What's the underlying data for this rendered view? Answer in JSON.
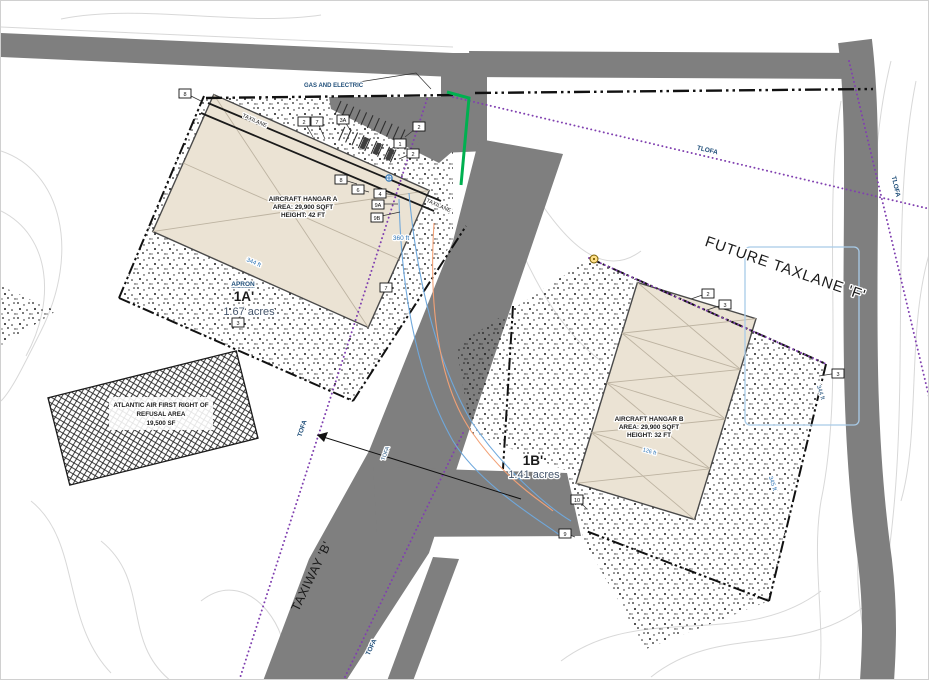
{
  "drawing": {
    "utilities_label": "GAS AND ELECTRIC",
    "future_taxlane_label": "FUTURE TAXLANE 'F'",
    "taxiway_label": "TAXIWAY 'B'"
  },
  "parcel_1a": {
    "apron_label": "APRON",
    "id": "1A'",
    "area": "1.67 acres",
    "hangar": {
      "line1": "AIRCRAFT HANGAR A",
      "line2": "AREA: 29,900 SQFT",
      "line3": "HEIGHT: 42 FT"
    }
  },
  "parcel_1b": {
    "id": "1B'",
    "area": "1.41 acres",
    "hangar": {
      "line1": "AIRCRAFT HANGAR B",
      "line2": "AREA: 29,900 SQFT",
      "line3": "HEIGHT: 32 FT"
    }
  },
  "atlantic_area": {
    "line1": "ATLANTIC AIR FIRST RIGHT OF",
    "line2": "REFUSAL AREA",
    "line3": "19,500 SF"
  },
  "clearance_labels": {
    "tofa": "TOFA",
    "tlofa": "TLOFA",
    "taxilane": "TAXILANE"
  },
  "dimensions": {
    "d360": "360 ft",
    "d344": "344 ft",
    "d345": "345 ft",
    "d126": "126 ft"
  },
  "colors": {
    "pavement": "#7f7f7f",
    "hangar_fill": "#ebe3d4",
    "ofa_line": "#8040b0",
    "utility_green": "#00b050",
    "utility_blue": "#6fa8dc",
    "utility_orange": "#f2a176",
    "dimension_text": "#2e74b5",
    "label_navy": "#1f4e79"
  },
  "callouts": [
    {
      "label": "8",
      "x": 178,
      "y": 88,
      "lx": 200,
      "ly": 100
    },
    {
      "label": "2",
      "x": 297,
      "y": 116,
      "lx": 312,
      "ly": 136
    },
    {
      "label": "7",
      "x": 310,
      "y": 116,
      "lx": 324,
      "ly": 138
    },
    {
      "label": "3A",
      "x": 336,
      "y": 114,
      "lx": 350,
      "ly": 130
    },
    {
      "label": "2",
      "x": 412,
      "y": 121,
      "lx": 404,
      "ly": 136
    },
    {
      "label": "1",
      "x": 393,
      "y": 138,
      "lx": 387,
      "ly": 150
    },
    {
      "label": "2",
      "x": 406,
      "y": 148,
      "lx": 398,
      "ly": 158
    },
    {
      "label": "8",
      "x": 334,
      "y": 174,
      "lx": 356,
      "ly": 183
    },
    {
      "label": "6",
      "x": 351,
      "y": 184,
      "lx": 368,
      "ly": 191
    },
    {
      "label": "4",
      "x": 373,
      "y": 188,
      "lx": 395,
      "ly": 194
    },
    {
      "label": "9A",
      "x": 371,
      "y": 199,
      "lx": 397,
      "ly": 203
    },
    {
      "label": "9B",
      "x": 370,
      "y": 212,
      "lx": 399,
      "ly": 211
    },
    {
      "label": "7",
      "x": 379,
      "y": 282,
      "lx": 391,
      "ly": 274
    },
    {
      "label": "3",
      "x": 231,
      "y": 317,
      "lx": 243,
      "ly": 305
    },
    {
      "label": "2",
      "x": 701,
      "y": 288,
      "lx": 690,
      "ly": 298
    },
    {
      "label": "3",
      "x": 718,
      "y": 299,
      "lx": 706,
      "ly": 309
    },
    {
      "label": "3",
      "x": 831,
      "y": 368,
      "lx": 818,
      "ly": 375
    },
    {
      "label": "10",
      "x": 570,
      "y": 494,
      "lx": 586,
      "ly": 508
    },
    {
      "label": "9",
      "x": 558,
      "y": 528,
      "lx": 574,
      "ly": 536
    }
  ]
}
